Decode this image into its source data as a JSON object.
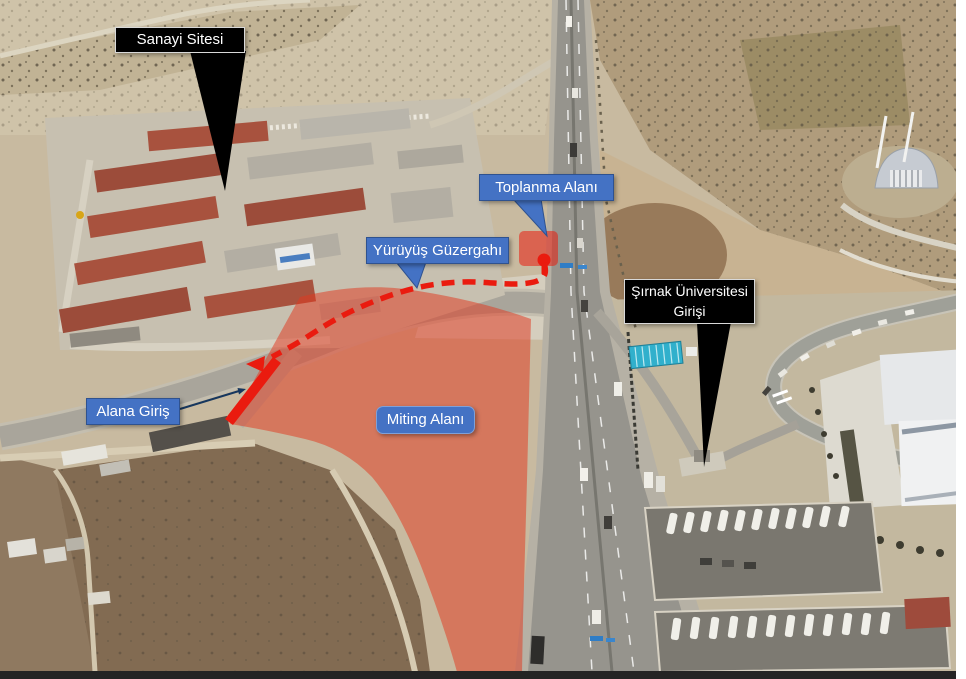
{
  "labels": {
    "sanayi_sitesi": "Sanayi Sitesi",
    "toplanma_alani": "Toplanma Alanı",
    "yuruyus_guzergahi": "Yürüyüş Güzergahı",
    "universite_line1": "Şırnak Üniversitesi",
    "universite_line2": "Girişi",
    "alana_giris": "Alana Giriş",
    "miting_alani": "Miting Alanı"
  },
  "colors": {
    "annotation_red": "#ea1b0f",
    "overlay_red_fill": "#e03a20",
    "label_blue": "#4472c4",
    "label_blue_border": "#2f528f",
    "label_black": "#000000",
    "label_text": "#ffffff"
  }
}
